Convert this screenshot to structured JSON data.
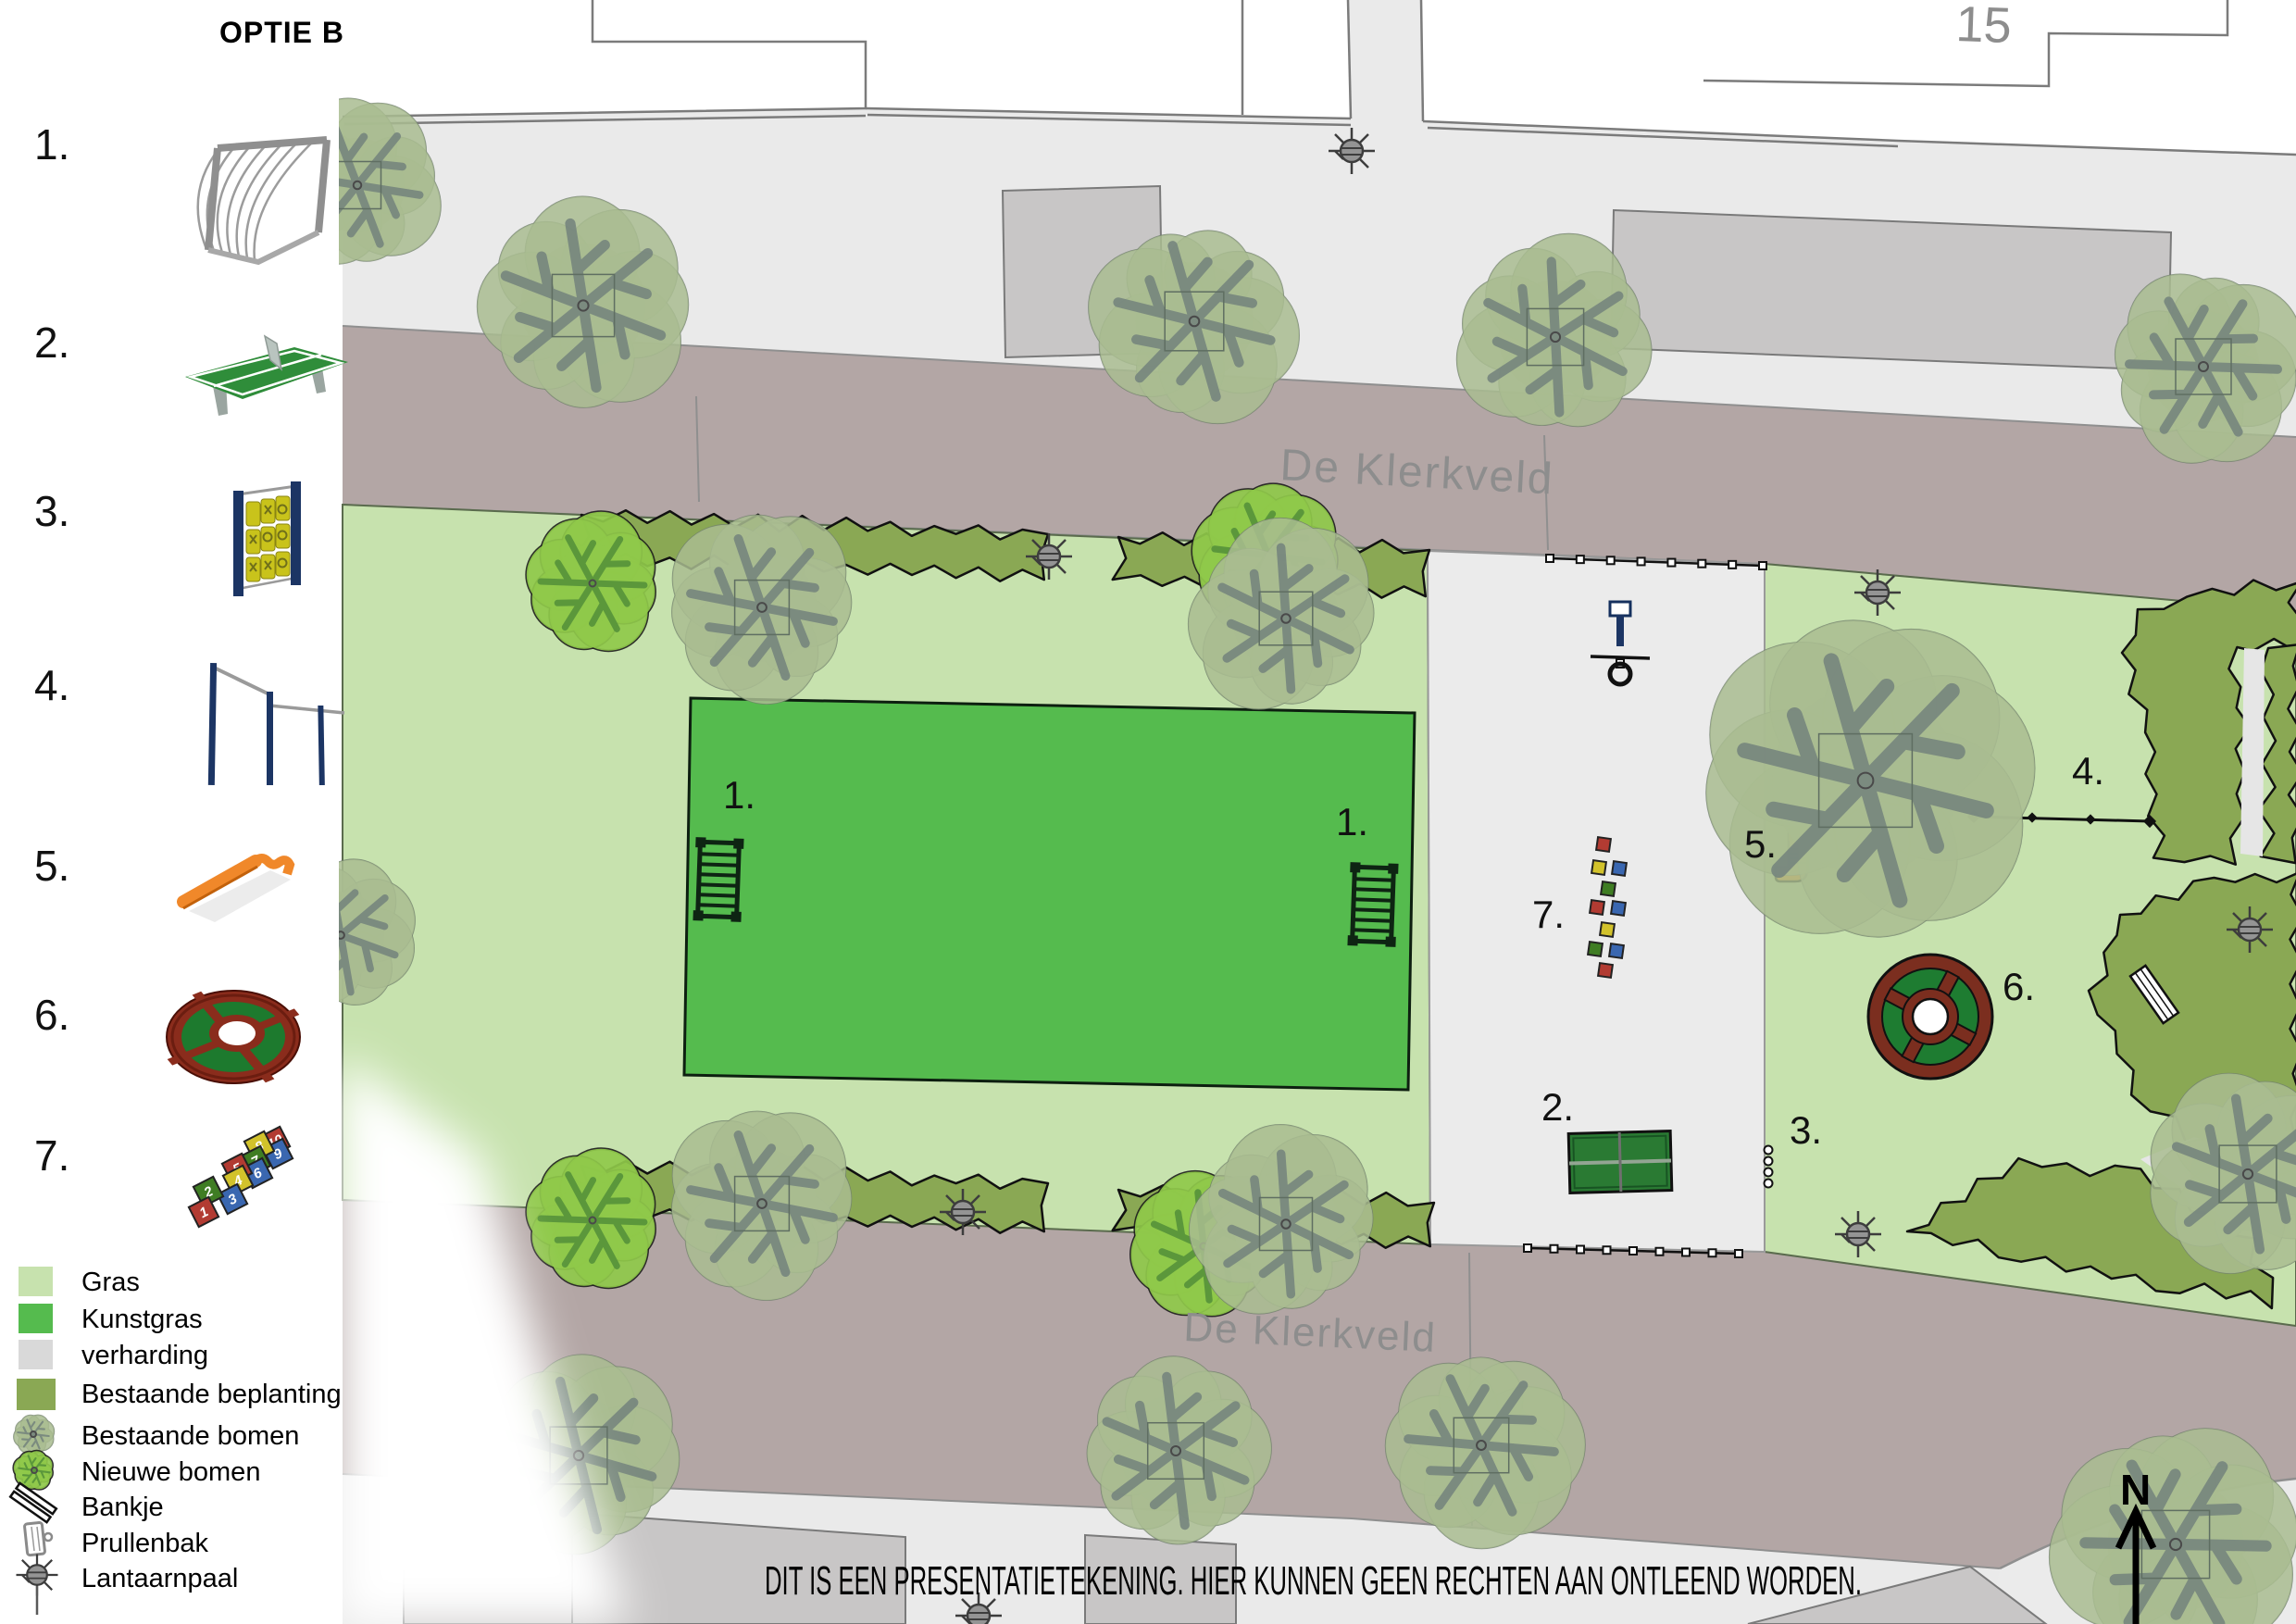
{
  "title": "OPTIE B",
  "equipment_legend": [
    {
      "label": "1.",
      "icon": "football-goal-icon"
    },
    {
      "label": "2.",
      "icon": "table-tennis-icon"
    },
    {
      "label": "3.",
      "icon": "tic-tac-toe-panel-icon"
    },
    {
      "label": "4.",
      "icon": "pull-up-bars-icon"
    },
    {
      "label": "5.",
      "icon": "balance-bench-icon"
    },
    {
      "label": "6.",
      "icon": "circular-trampoline-icon"
    },
    {
      "label": "7.",
      "icon": "hopscotch-icon"
    }
  ],
  "color_legend": [
    {
      "label": "Gras",
      "color": "#c7e2ae"
    },
    {
      "label": "Kunstgras",
      "color": "#55bb4e"
    },
    {
      "label": "verharding",
      "color": "#d9d9d9"
    },
    {
      "label": "Bestaande beplanting",
      "color": "#8aa854"
    },
    {
      "label": "Bestaande bomen",
      "icon": "existing-tree-icon"
    },
    {
      "label": "Nieuwe bomen",
      "icon": "new-tree-icon"
    },
    {
      "label": "Bankje",
      "icon": "bench-icon"
    },
    {
      "label": "Prullenbak",
      "icon": "trash-bin-icon"
    },
    {
      "label": "Lantaarnpaal",
      "icon": "lamp-post-icon"
    }
  ],
  "hopscotch_numbers": [
    "1",
    "2",
    "3",
    "4",
    "5",
    "6",
    "7",
    "8",
    "9",
    "10"
  ],
  "map": {
    "street_top": "De Klerkveld",
    "street_bottom": "De Klerkveld",
    "house_number": "15",
    "north": "N",
    "disclaimer": "DIT IS EEN PRESENTATIETEKENING. HIER KUNNEN GEEN RECHTEN AAN ONTLEEND WORDEN.",
    "markers": [
      {
        "label": "1."
      },
      {
        "label": "1."
      },
      {
        "label": "2."
      },
      {
        "label": "3."
      },
      {
        "label": "4."
      },
      {
        "label": "5."
      },
      {
        "label": "6."
      },
      {
        "label": "7."
      }
    ]
  },
  "colors": {
    "gras": "#c7e2ae",
    "kunstgras": "#55bb4e",
    "verharding": "#eaeaea",
    "beplanting": "#8aa854",
    "street": "#b3a6a5",
    "street_text": "#8d8d8d",
    "building_grey": "#c8c6c6",
    "outline": "#7b7b7b",
    "tree_existing": "#a9bc91",
    "tree_new": "#8fc94a",
    "orange": "#f0882a",
    "navy": "#1c3564",
    "ring_red": "#7b2e1f",
    "ring_green": "#1e7c31"
  }
}
